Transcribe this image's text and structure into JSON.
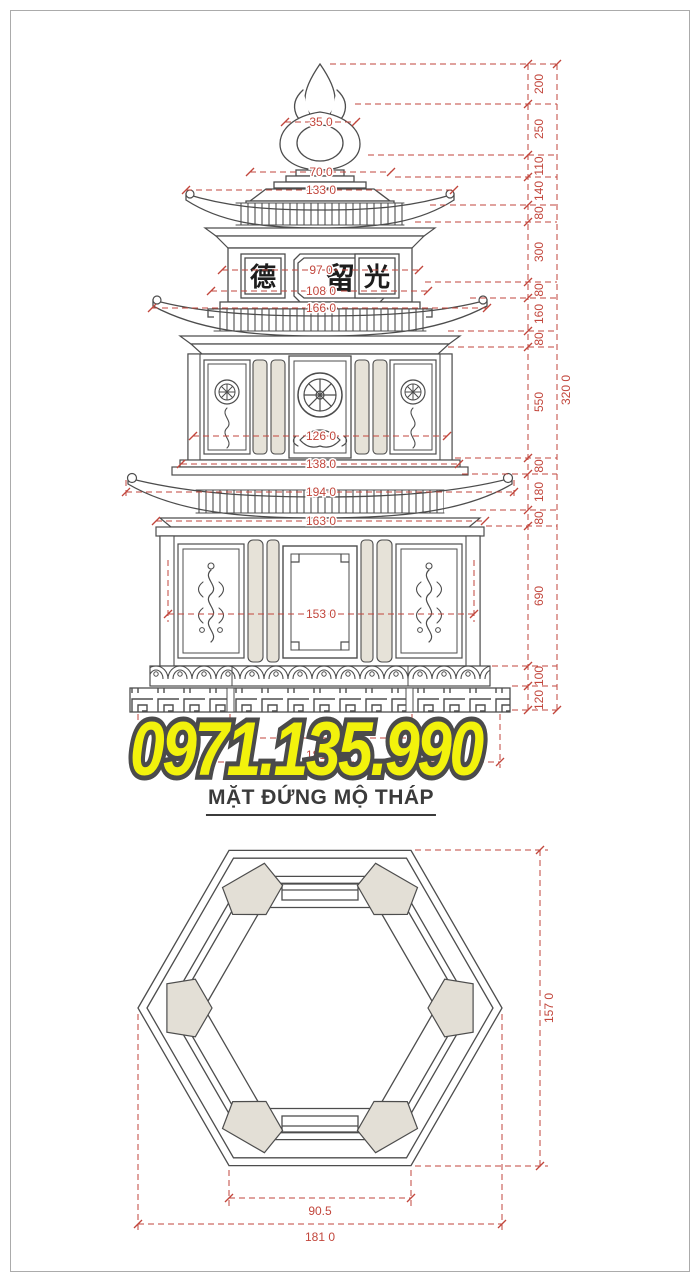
{
  "colors": {
    "line": "#4d4d4d",
    "dimension_red": "#c2463c",
    "phone_yellow": "#f2f20c",
    "phone_outline": "#4b4b4b",
    "panel_fill": "#e6e2d8",
    "title_gray": "#3b3b3b"
  },
  "phone": {
    "number": "0971.135.990"
  },
  "title": {
    "text": "MẶT ĐỨNG MỘ THÁP"
  },
  "elevation": {
    "motifs": [
      "lotus-finial",
      "pagoda-roof",
      "dharma-wheel",
      "lotus-flower",
      "scroll-band",
      "greek-key-band"
    ],
    "panel_characters": [
      "德",
      "留",
      "光"
    ],
    "dims_horizontal": [
      "35 0",
      "70 0",
      "133 0",
      "97 0",
      "108 0",
      "166 0",
      "126 0",
      "138 0",
      "194 0",
      "163 0",
      "153 0"
    ],
    "dims_base": [
      "90.5",
      "181 0"
    ],
    "dims_right_chain": [
      "200",
      "250",
      "110",
      "140",
      "80",
      "300",
      "80",
      "160",
      "80",
      "550",
      "80",
      "180",
      "80",
      "690",
      "100",
      "120"
    ],
    "dim_total_height": "320 0"
  },
  "plan": {
    "dim_inner_width": "90.5",
    "dim_total_width": "181 0",
    "dim_total_height": "157 0"
  }
}
